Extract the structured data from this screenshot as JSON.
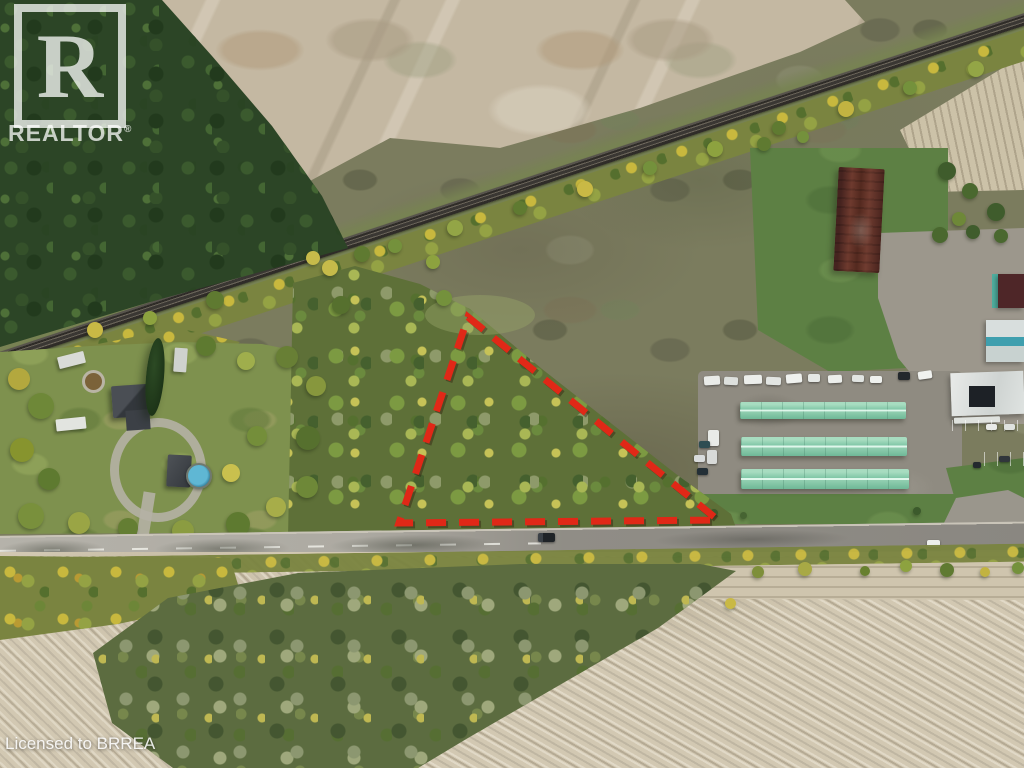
{
  "watermark": {
    "letter": "R",
    "brand": "REALTOR",
    "registered": "®"
  },
  "license": {
    "text": "Licensed to BRREA"
  },
  "boundary": {
    "points": "468,317 718,520 399,523",
    "shadow_points": "470,319 720,522 401,525",
    "color": "#e02817",
    "dash": "20 13",
    "stroke_width": "7"
  },
  "palette": {
    "boundary_red": "#e02817",
    "forest_green": "#2c4526",
    "parcel_woods": "#5e7038",
    "scrub_field": "#7b7c5e",
    "dirt_clearing": "#c4b8a2",
    "harvested_field": "#d2c8b2",
    "road_gray": "#a5a29a",
    "storage_roof_mint": "#7fc6a6",
    "barn_roof_maroon": "#5a2e26",
    "pool_blue": "#4aa6c4",
    "watermark_white": "rgba(255,255,255,0.74)"
  }
}
